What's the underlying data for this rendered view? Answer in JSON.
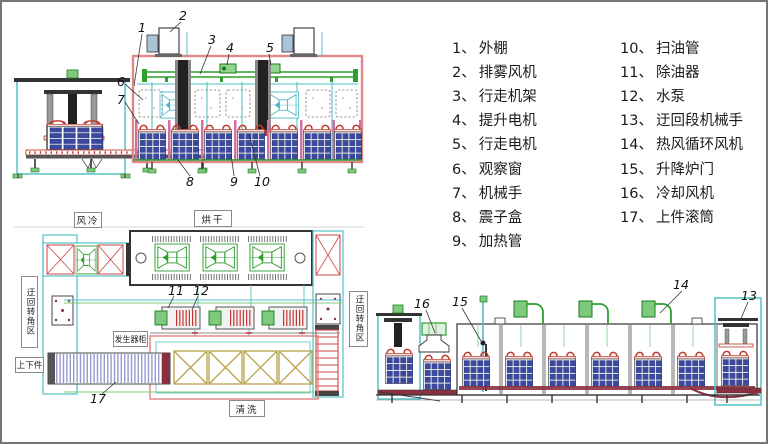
{
  "legend": {
    "col1": [
      {
        "num": "1、",
        "label": "外棚"
      },
      {
        "num": "2、",
        "label": "排雾风机"
      },
      {
        "num": "3、",
        "label": "行走机架"
      },
      {
        "num": "4、",
        "label": "提升电机"
      },
      {
        "num": "5、",
        "label": "行走电机"
      },
      {
        "num": "6、",
        "label": "观察窗"
      },
      {
        "num": "7、",
        "label": "机械手"
      },
      {
        "num": "8、",
        "label": "震子盒"
      },
      {
        "num": "9、",
        "label": "加热管"
      }
    ],
    "col2": [
      {
        "num": "10、",
        "label": "扫油管"
      },
      {
        "num": "11、",
        "label": "除油器"
      },
      {
        "num": "12、",
        "label": "水泵"
      },
      {
        "num": "13、",
        "label": "迂回段机械手"
      },
      {
        "num": "14、",
        "label": "热风循环风机"
      },
      {
        "num": "15、",
        "label": "升降炉门"
      },
      {
        "num": "16、",
        "label": "冷却风机"
      },
      {
        "num": "17、",
        "label": "上件滚筒"
      }
    ]
  },
  "callouts": {
    "c1": "1",
    "c2": "2",
    "c3": "3",
    "c4": "4",
    "c5": "5",
    "c6": "6",
    "c7": "7",
    "c8": "8",
    "c9": "9",
    "c10": "10",
    "c11": "11",
    "c12": "12",
    "c13": "13",
    "c14": "14",
    "c15": "15",
    "c16": "16",
    "c17": "17"
  },
  "process_labels": {
    "air_cool": "风冷",
    "drying": "烘干",
    "washing": "清洗",
    "generator_cabinet": "发生器柜",
    "load_unload": "上下件",
    "detour_left": "迂回转角区",
    "detour_right": "迂回转角区"
  },
  "colors": {
    "shed_pink": "#e08888",
    "frame_cyan": "#52c2c6",
    "machine_green": "#2f9e2f",
    "basket_navy": "#3b4a9e",
    "hook_red": "#c0392b",
    "tank_magenta": "#d070a8",
    "conveyor_maroon": "#8b3040",
    "roller_purple": "#9a9ad0",
    "wash_olive": "#b8a24a",
    "xbox_red": "#cc4444",
    "outline": "#333333"
  }
}
